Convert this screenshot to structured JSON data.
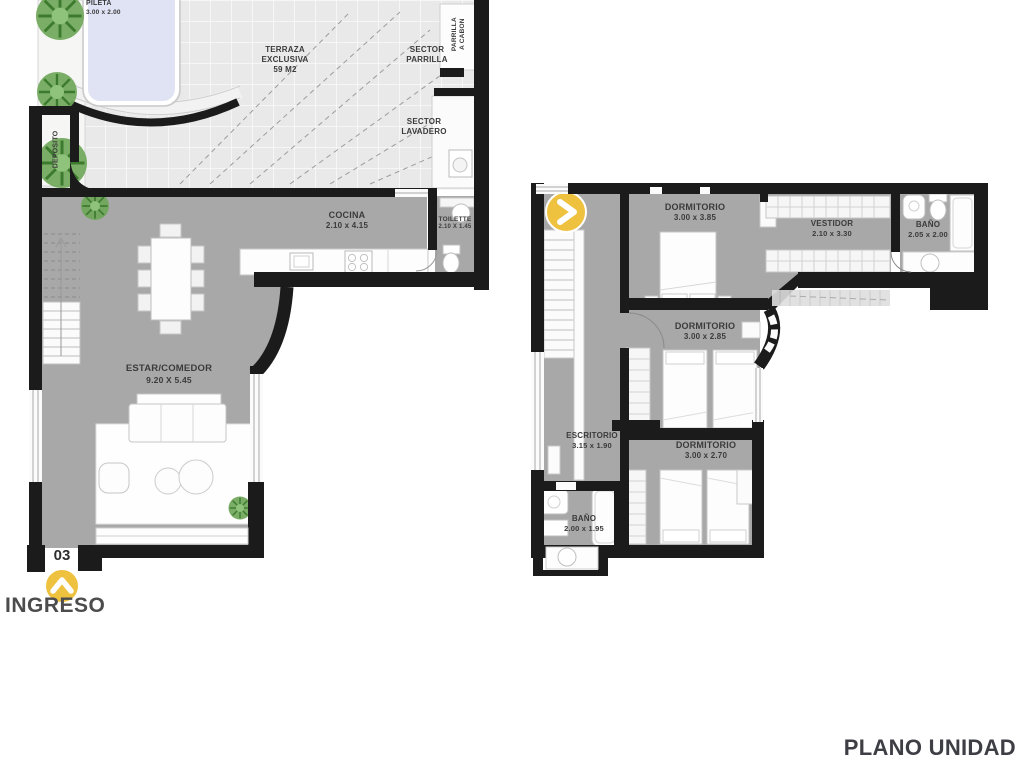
{
  "title": "PLANO UNIDAD",
  "entrance": {
    "unit_number": "03",
    "label": "INGRESO"
  },
  "colors": {
    "floor_gray": "#a8a8a8",
    "wall_black": "#1b1b1b",
    "terrace_tile": "#e9e9e9",
    "pool_water": "#dfe3f4",
    "accent_yellow": "#eec13f",
    "plant_green": "#6fa75a",
    "label_text": "#3b3b3b"
  },
  "lower_floor": {
    "pileta": {
      "name": "PILETA",
      "dims": "3.00 x 2.00"
    },
    "terraza": {
      "line1": "TERRAZA",
      "line2": "EXCLUSIVA",
      "line3": "59 M2"
    },
    "sector_parrilla": {
      "line1": "SECTOR",
      "line2": "PARRILLA"
    },
    "parrilla_carbon": {
      "line1": "PARRILLA",
      "line2": "A CABON"
    },
    "sector_lavadero": {
      "line1": "SECTOR",
      "line2": "LAVADERO"
    },
    "deposito": {
      "name": "DEPOSITO"
    },
    "cocina": {
      "name": "COCINA",
      "dims": "2.10 x 4.15"
    },
    "toilette": {
      "name": "TOILETTE",
      "dims": "2.10 X 1.45"
    },
    "estar_comedor": {
      "name": "ESTAR/COMEDOR",
      "dims": "9.20 X 5.45"
    }
  },
  "upper_floor": {
    "dormitorio_1": {
      "name": "DORMITORIO",
      "dims": "3.00 x 3.85"
    },
    "vestidor": {
      "name": "VESTIDOR",
      "dims": "2.10 x 3.30"
    },
    "bano_suite": {
      "name": "BAÑO",
      "dims": "2.05 x 2.00"
    },
    "dormitorio_2": {
      "name": "DORMITORIO",
      "dims": "3.00 x 2.85"
    },
    "escritorio": {
      "name": "ESCRITORIO",
      "dims": "3.15 x 1.90"
    },
    "dormitorio_3": {
      "name": "DORMITORIO",
      "dims": "3.00 x 2.70"
    },
    "bano_2": {
      "name": "BAÑO",
      "dims": "2.00 x 1.95"
    }
  }
}
